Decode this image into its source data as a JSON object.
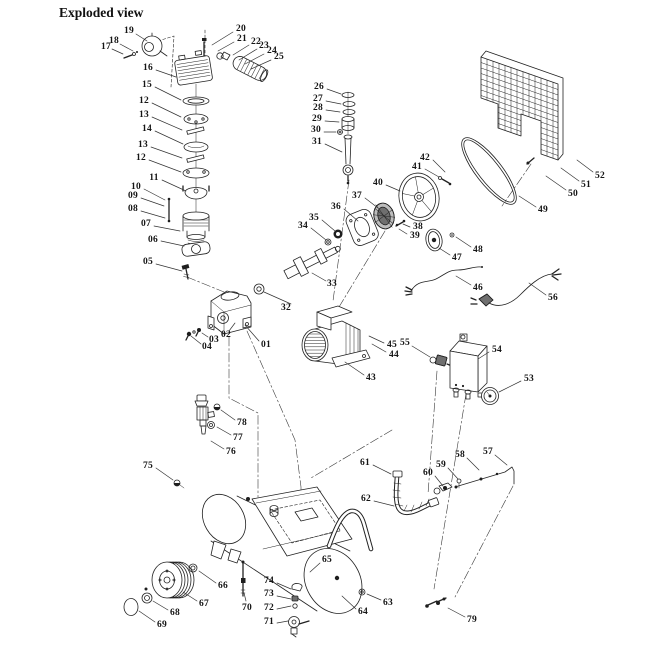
{
  "title": "Exploded view",
  "ink": "#222222",
  "paper": "#ffffff",
  "figure": {
    "type": "exploded-parts-diagram",
    "part_count": 79
  },
  "labels": [
    {
      "n": "19",
      "x": 129,
      "y": 31,
      "l": [
        136,
        34,
        147,
        41
      ]
    },
    {
      "n": "18",
      "x": 114,
      "y": 41,
      "l": [
        120,
        44,
        133,
        51
      ]
    },
    {
      "n": "17",
      "x": 106,
      "y": 47,
      "l": [
        112,
        49,
        123,
        54
      ]
    },
    {
      "n": "16",
      "x": 148,
      "y": 68,
      "l": [
        156,
        70,
        176,
        77
      ]
    },
    {
      "n": "15",
      "x": 147,
      "y": 85,
      "l": [
        155,
        87,
        181,
        100
      ]
    },
    {
      "n": "12",
      "x": 144,
      "y": 101,
      "l": [
        152,
        103,
        181,
        117
      ]
    },
    {
      "n": "13",
      "x": 144,
      "y": 115,
      "l": [
        152,
        117,
        182,
        130
      ]
    },
    {
      "n": "14",
      "x": 147,
      "y": 129,
      "l": [
        155,
        131,
        183,
        144
      ]
    },
    {
      "n": "13",
      "x": 143,
      "y": 145,
      "l": [
        151,
        147,
        182,
        158
      ]
    },
    {
      "n": "12",
      "x": 141,
      "y": 158,
      "l": [
        149,
        160,
        181,
        172
      ]
    },
    {
      "n": "11",
      "x": 154,
      "y": 178,
      "l": [
        162,
        180,
        186,
        191
      ]
    },
    {
      "n": "10",
      "x": 136,
      "y": 187,
      "l": [
        144,
        189,
        165,
        200
      ]
    },
    {
      "n": "09",
      "x": 133,
      "y": 196,
      "l": [
        141,
        198,
        164,
        206
      ]
    },
    {
      "n": "08",
      "x": 133,
      "y": 209,
      "l": [
        141,
        211,
        165,
        218
      ]
    },
    {
      "n": "07",
      "x": 146,
      "y": 224,
      "l": [
        154,
        226,
        180,
        231
      ]
    },
    {
      "n": "06",
      "x": 153,
      "y": 240,
      "l": [
        161,
        241,
        184,
        246
      ]
    },
    {
      "n": "05",
      "x": 148,
      "y": 262,
      "l": [
        156,
        264,
        182,
        271
      ]
    },
    {
      "n": "20",
      "x": 241,
      "y": 29,
      "l": [
        233,
        32,
        212,
        45
      ]
    },
    {
      "n": "21",
      "x": 242,
      "y": 39,
      "l": [
        234,
        42,
        218,
        51
      ]
    },
    {
      "n": "22",
      "x": 256,
      "y": 42,
      "l": [
        249,
        45,
        233,
        55
      ]
    },
    {
      "n": "23",
      "x": 264,
      "y": 46,
      "l": [
        257,
        49,
        239,
        60
      ]
    },
    {
      "n": "24",
      "x": 272,
      "y": 51,
      "l": [
        264,
        54,
        245,
        64
      ]
    },
    {
      "n": "25",
      "x": 279,
      "y": 57,
      "l": [
        271,
        60,
        251,
        69
      ]
    },
    {
      "n": "26",
      "x": 319,
      "y": 87,
      "l": [
        327,
        89,
        341,
        94
      ]
    },
    {
      "n": "27",
      "x": 318,
      "y": 99,
      "l": [
        326,
        101,
        341,
        104
      ]
    },
    {
      "n": "28",
      "x": 318,
      "y": 108,
      "l": [
        326,
        110,
        340,
        112
      ]
    },
    {
      "n": "29",
      "x": 317,
      "y": 119,
      "l": [
        325,
        121,
        339,
        122
      ]
    },
    {
      "n": "30",
      "x": 316,
      "y": 130,
      "l": [
        324,
        132,
        336,
        132
      ]
    },
    {
      "n": "31",
      "x": 317,
      "y": 142,
      "l": [
        325,
        144,
        342,
        152
      ]
    },
    {
      "n": "32",
      "x": 286,
      "y": 308,
      "l": [
        291,
        304,
        264,
        292
      ]
    },
    {
      "n": "33",
      "x": 332,
      "y": 284,
      "l": [
        326,
        281,
        312,
        273
      ]
    },
    {
      "n": "34",
      "x": 303,
      "y": 226,
      "l": [
        311,
        228,
        326,
        240
      ]
    },
    {
      "n": "35",
      "x": 314,
      "y": 218,
      "l": [
        322,
        220,
        335,
        231
      ]
    },
    {
      "n": "36",
      "x": 336,
      "y": 207,
      "l": [
        344,
        209,
        358,
        221
      ]
    },
    {
      "n": "37",
      "x": 357,
      "y": 196,
      "l": [
        365,
        198,
        378,
        208
      ]
    },
    {
      "n": "38",
      "x": 418,
      "y": 227,
      "l": [
        410,
        227,
        403,
        224
      ]
    },
    {
      "n": "39",
      "x": 415,
      "y": 236,
      "l": [
        407,
        234,
        399,
        229
      ]
    },
    {
      "n": "40",
      "x": 378,
      "y": 183,
      "l": [
        386,
        185,
        400,
        191
      ]
    },
    {
      "n": "41",
      "x": 417,
      "y": 167,
      "l": [
        425,
        169,
        439,
        177
      ]
    },
    {
      "n": "42",
      "x": 425,
      "y": 158,
      "l": [
        433,
        160,
        445,
        172
      ]
    },
    {
      "n": "43",
      "x": 371,
      "y": 378,
      "l": [
        364,
        375,
        345,
        362
      ]
    },
    {
      "n": "44",
      "x": 394,
      "y": 355,
      "l": [
        386,
        352,
        372,
        344
      ]
    },
    {
      "n": "45",
      "x": 392,
      "y": 345,
      "l": [
        384,
        343,
        369,
        336
      ]
    },
    {
      "n": "55",
      "x": 405,
      "y": 343,
      "l": [
        412,
        346,
        430,
        357
      ]
    },
    {
      "n": "46",
      "x": 478,
      "y": 288,
      "l": [
        471,
        285,
        456,
        276
      ]
    },
    {
      "n": "47",
      "x": 457,
      "y": 258,
      "l": [
        450,
        255,
        439,
        248
      ]
    },
    {
      "n": "48",
      "x": 478,
      "y": 250,
      "l": [
        471,
        247,
        456,
        237
      ]
    },
    {
      "n": "49",
      "x": 543,
      "y": 210,
      "l": [
        536,
        207,
        519,
        196
      ]
    },
    {
      "n": "50",
      "x": 573,
      "y": 194,
      "l": [
        566,
        190,
        546,
        176
      ]
    },
    {
      "n": "51",
      "x": 586,
      "y": 185,
      "l": [
        579,
        181,
        561,
        168
      ]
    },
    {
      "n": "52",
      "x": 600,
      "y": 176,
      "l": [
        593,
        172,
        577,
        160
      ]
    },
    {
      "n": "53",
      "x": 529,
      "y": 379,
      "l": [
        521,
        381,
        499,
        392
      ]
    },
    {
      "n": "54",
      "x": 497,
      "y": 350,
      "l": [
        489,
        352,
        478,
        359
      ]
    },
    {
      "n": "56",
      "x": 553,
      "y": 298,
      "l": [
        546,
        295,
        529,
        283
      ]
    },
    {
      "n": "57",
      "x": 488,
      "y": 452,
      "l": [
        495,
        455,
        507,
        465
      ]
    },
    {
      "n": "58",
      "x": 460,
      "y": 455,
      "l": [
        467,
        458,
        479,
        470
      ]
    },
    {
      "n": "59",
      "x": 441,
      "y": 465,
      "l": [
        448,
        468,
        458,
        479
      ]
    },
    {
      "n": "60",
      "x": 428,
      "y": 473,
      "l": [
        435,
        476,
        443,
        486
      ]
    },
    {
      "n": "61",
      "x": 365,
      "y": 463,
      "l": [
        373,
        465,
        391,
        474
      ]
    },
    {
      "n": "62",
      "x": 366,
      "y": 499,
      "l": [
        374,
        501,
        394,
        506
      ]
    },
    {
      "n": "63",
      "x": 388,
      "y": 603,
      "l": [
        381,
        600,
        367,
        594
      ]
    },
    {
      "n": "64",
      "x": 363,
      "y": 612,
      "l": [
        356,
        609,
        342,
        596
      ]
    },
    {
      "n": "65",
      "x": 327,
      "y": 560,
      "l": [
        320,
        563,
        310,
        572
      ]
    },
    {
      "n": "66",
      "x": 223,
      "y": 586,
      "l": [
        216,
        583,
        199,
        571
      ]
    },
    {
      "n": "67",
      "x": 204,
      "y": 604,
      "l": [
        197,
        601,
        183,
        592
      ]
    },
    {
      "n": "68",
      "x": 175,
      "y": 613,
      "l": [
        168,
        610,
        153,
        601
      ]
    },
    {
      "n": "69",
      "x": 162,
      "y": 625,
      "l": [
        155,
        622,
        139,
        611
      ]
    },
    {
      "n": "70",
      "x": 247,
      "y": 608,
      "l": [
        246,
        601,
        244,
        593
      ]
    },
    {
      "n": "71",
      "x": 269,
      "y": 622,
      "l": [
        277,
        623,
        288,
        621
      ]
    },
    {
      "n": "72",
      "x": 269,
      "y": 608,
      "l": [
        277,
        609,
        291,
        606
      ]
    },
    {
      "n": "73",
      "x": 269,
      "y": 594,
      "l": [
        277,
        596,
        291,
        599
      ]
    },
    {
      "n": "74",
      "x": 269,
      "y": 581,
      "l": [
        277,
        583,
        291,
        589
      ]
    },
    {
      "n": "75",
      "x": 148,
      "y": 466,
      "l": [
        156,
        468,
        173,
        480
      ]
    },
    {
      "n": "76",
      "x": 231,
      "y": 452,
      "l": [
        224,
        449,
        211,
        441
      ]
    },
    {
      "n": "77",
      "x": 238,
      "y": 438,
      "l": [
        231,
        435,
        217,
        427
      ]
    },
    {
      "n": "78",
      "x": 242,
      "y": 423,
      "l": [
        235,
        420,
        221,
        410
      ]
    },
    {
      "n": "79",
      "x": 472,
      "y": 620,
      "l": [
        465,
        617,
        448,
        608
      ]
    },
    {
      "n": "01",
      "x": 266,
      "y": 345,
      "l": [
        259,
        341,
        245,
        325
      ]
    },
    {
      "n": "02",
      "x": 226,
      "y": 335,
      "l": [
        229,
        331,
        235,
        323
      ]
    },
    {
      "n": "03",
      "x": 214,
      "y": 340,
      "l": [
        208,
        337,
        202,
        333
      ]
    },
    {
      "n": "04",
      "x": 207,
      "y": 347,
      "l": [
        201,
        344,
        191,
        336
      ]
    }
  ]
}
